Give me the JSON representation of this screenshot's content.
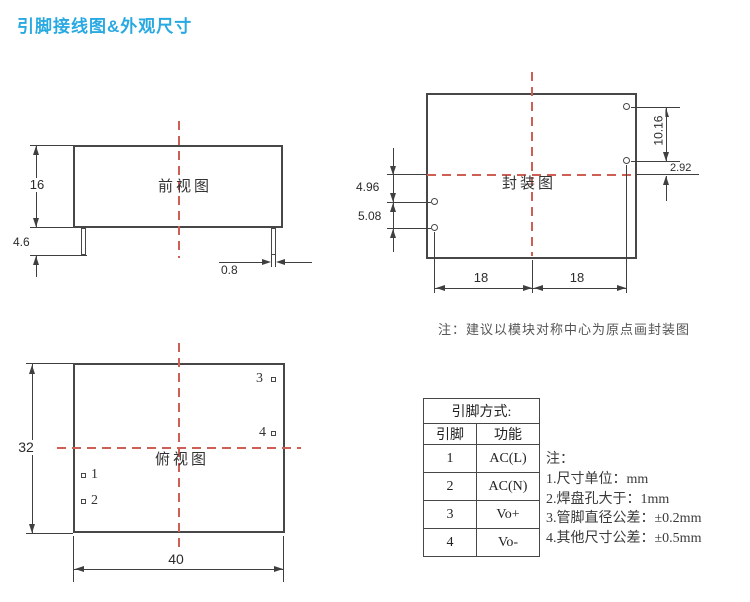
{
  "title": "引脚接线图&外观尺寸",
  "colors": {
    "accent": "#29a9e1",
    "centerline_red": "#cd5f55",
    "line_dark": "#3f3f3f"
  },
  "front_view": {
    "label": "前视图",
    "dims": {
      "body_height": "16",
      "pin_length": "4.6",
      "pin_width": "0.8"
    }
  },
  "package_view": {
    "label": "封装图",
    "dims": {
      "right_pin_pitch": "10.16",
      "right_pin_offset": "2.92",
      "left_pin_offset": "4.96",
      "left_pin_pitch": "5.08",
      "left_half_width": "18",
      "right_half_width": "18"
    },
    "note": "注：建议以模块对称中心为原点画封装图"
  },
  "top_view": {
    "label": "俯视图",
    "dims": {
      "body_depth": "32",
      "body_width": "40"
    },
    "pins": [
      "1",
      "2",
      "3",
      "4"
    ]
  },
  "pin_table": {
    "title": "引脚方式:",
    "columns": [
      "引脚",
      "功能"
    ],
    "rows": [
      [
        "1",
        "AC(L)"
      ],
      [
        "2",
        "AC(N)"
      ],
      [
        "3",
        "Vo+"
      ],
      [
        "4",
        "Vo-"
      ]
    ]
  },
  "notes": [
    "注：",
    "1.尺寸单位：mm",
    "2.焊盘孔大于：1mm",
    "3.管脚直径公差：±0.2mm",
    "4.其他尺寸公差：±0.5mm"
  ]
}
